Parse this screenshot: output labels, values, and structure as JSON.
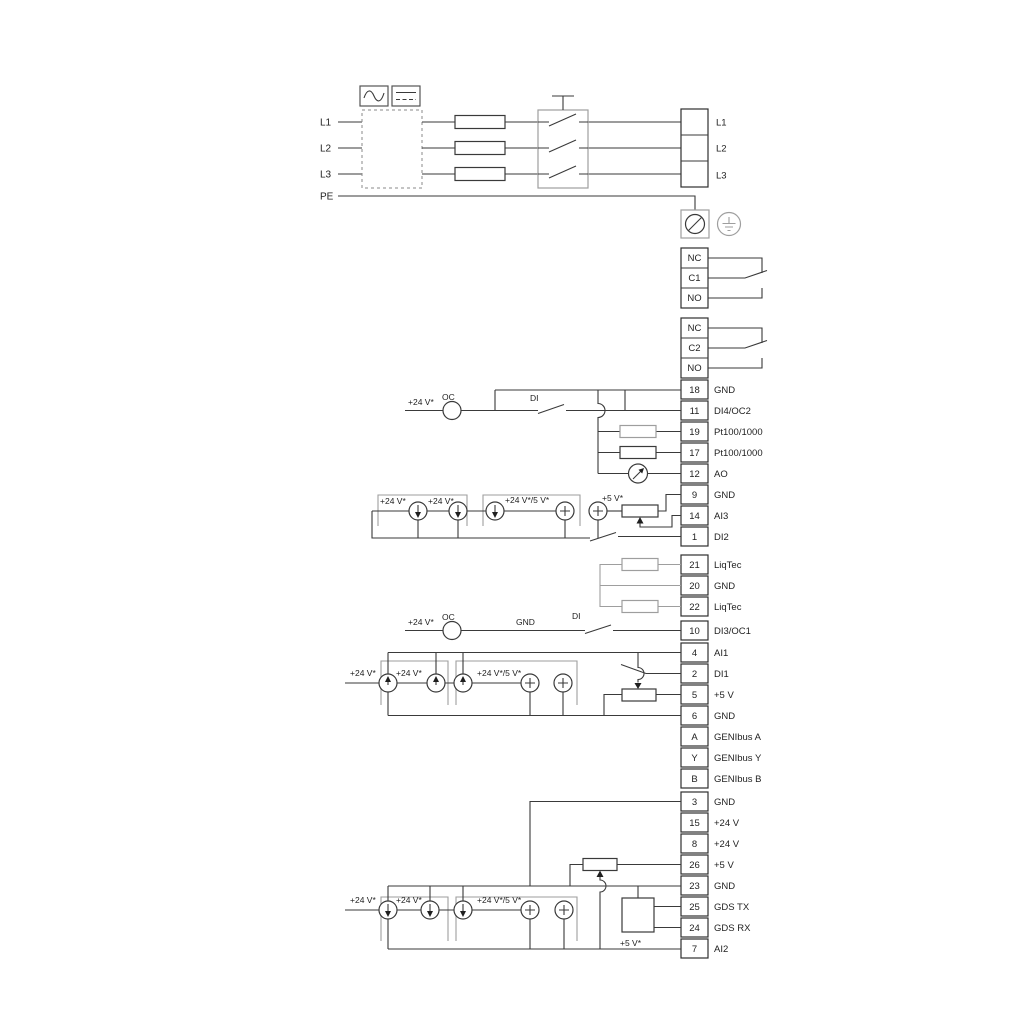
{
  "colors": {
    "line": "#3a3a3a",
    "gray": "#9e9e9e",
    "background": "#ffffff"
  },
  "power": {
    "inputs": {
      "l1": "L1",
      "l2": "L2",
      "l3": "L3",
      "pe": "PE"
    },
    "outputs": {
      "l1": "L1",
      "l2": "L2",
      "l3": "L3"
    }
  },
  "relays": {
    "relay1": {
      "nc": "NC",
      "common": "C1",
      "no": "NO"
    },
    "relay2": {
      "nc": "NC",
      "common": "C2",
      "no": "NO"
    }
  },
  "io_group1": {
    "rows": [
      {
        "num": "18",
        "label": "GND"
      },
      {
        "num": "11",
        "label": "DI4/OC2"
      },
      {
        "num": "19",
        "label": "Pt100/1000"
      },
      {
        "num": "17",
        "label": "Pt100/1000"
      },
      {
        "num": "12",
        "label": "AO"
      },
      {
        "num": "9",
        "label": "GND"
      },
      {
        "num": "14",
        "label": "AI3"
      },
      {
        "num": "1",
        "label": "DI2"
      }
    ],
    "annotations": {
      "v24": "+24 V*",
      "oc": "OC",
      "di": "DI"
    },
    "options": {
      "v24a": "+24 V*",
      "v24b": "+24 V*",
      "v24_5": "+24 V*/5 V*",
      "v5": "+5 V*"
    }
  },
  "liqtec_group": {
    "rows": [
      {
        "num": "21",
        "label": "LiqTec"
      },
      {
        "num": "20",
        "label": "GND"
      },
      {
        "num": "22",
        "label": "LiqTec"
      }
    ]
  },
  "di3_group": {
    "row": {
      "num": "10",
      "label": "DI3/OC1"
    },
    "annotations": {
      "v24": "+24 V*",
      "oc": "OC",
      "gnd": "GND",
      "di": "DI"
    }
  },
  "io_group2": {
    "rows": [
      {
        "num": "4",
        "label": "AI1"
      },
      {
        "num": "2",
        "label": "DI1"
      },
      {
        "num": "5",
        "label": "+5 V"
      },
      {
        "num": "6",
        "label": "GND"
      },
      {
        "num": "A",
        "label": "GENIbus A"
      },
      {
        "num": "Y",
        "label": "GENIbus Y"
      },
      {
        "num": "B",
        "label": "GENIbus B"
      }
    ],
    "options": {
      "v24a": "+24 V*",
      "v24b": "+24 V*",
      "v24_5": "+24 V*/5 V*"
    }
  },
  "io_group3": {
    "rows": [
      {
        "num": "3",
        "label": "GND"
      },
      {
        "num": "15",
        "label": "+24 V"
      },
      {
        "num": "8",
        "label": "+24 V"
      },
      {
        "num": "26",
        "label": "+5 V"
      },
      {
        "num": "23",
        "label": "GND"
      },
      {
        "num": "25",
        "label": "GDS TX"
      },
      {
        "num": "24",
        "label": "GDS RX"
      },
      {
        "num": "7",
        "label": "AI2"
      }
    ],
    "options": {
      "v24a": "+24 V*",
      "v24b": "+24 V*",
      "v24_5": "+24 V*/5 V*",
      "v5": "+5 V*"
    }
  }
}
